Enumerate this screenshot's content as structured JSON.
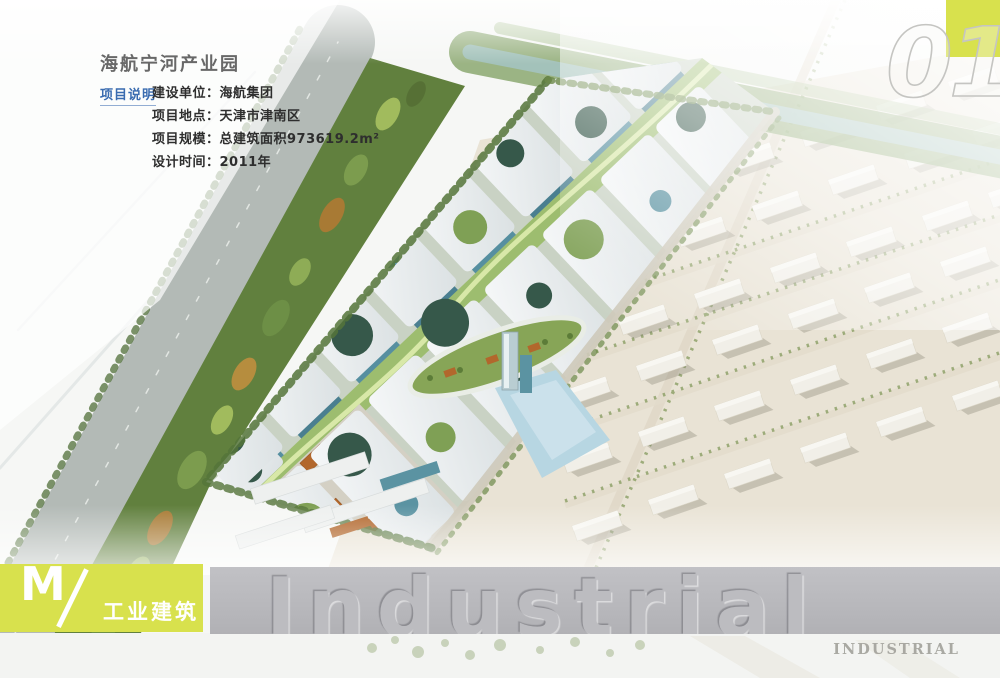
{
  "page": {
    "number": "01"
  },
  "header": {
    "title": "海航宁河产业园",
    "section_label": "项目说明",
    "info_rows": [
      "建设单位：海航集团",
      "项目地点：天津市津南区",
      "项目规模：总建筑面积973619.2m²",
      "设计时间：2011年"
    ]
  },
  "footer": {
    "letter": "M",
    "category": "工业建筑",
    "watermark": "Industrial",
    "stamp": "INDUSTRIAL"
  },
  "colors": {
    "accent_yellow": "#d8e14d",
    "label_blue": "#3a6cb0",
    "band_gray": "#b9b9bd"
  }
}
